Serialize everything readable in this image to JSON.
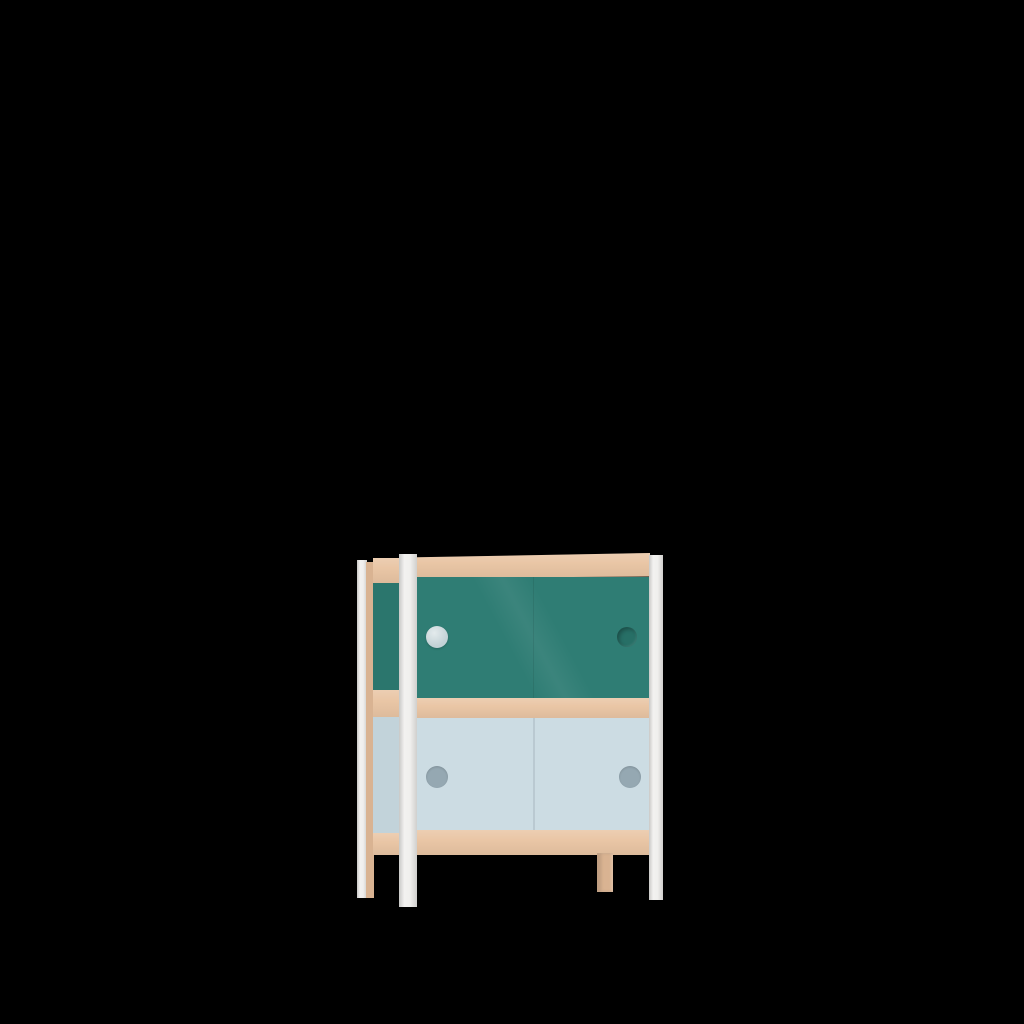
{
  "scene": {
    "kind": "3d-product-render",
    "description": "Two-tier cabinet with sliding doors: teal upper doors, pale blue lower doors, birch wood rails and white frame posts, rendered on a black background",
    "background_color": "#000000"
  },
  "cabinet": {
    "colors": {
      "wood": "#e9c5a4",
      "wood_shaded": "#d9b392",
      "upper_door_teal": "#2f7d74",
      "upper_side_teal": "#2b766d",
      "lower_door_blue": "#ccdce3",
      "lower_side_blue": "#c2d3da",
      "post_white": "#efeeec",
      "upper_left_handle": "#c3d2d6",
      "upper_right_handle": "#276f66",
      "lower_handle": "#95a8b2",
      "door_seam": "#bac9d1"
    },
    "parts": {
      "rear_left_post": "rear left post",
      "side_wood_edge": "side panel wood edge",
      "side_top_rail": "side top rail",
      "side_upper_panel": "upper side panel",
      "side_middle_rail": "side middle rail",
      "side_lower_panel": "lower side panel",
      "side_bottom_rail": "side bottom rail",
      "top_rail": "front top rail",
      "upper_doors": "upper sliding doors",
      "upper_left_handle": "upper left door finger hole",
      "upper_right_handle": "upper right door finger hole",
      "middle_rail": "front middle rail",
      "lower_doors": "lower sliding doors",
      "lower_left_handle": "lower left door finger hole",
      "lower_right_handle": "lower right door finger hole",
      "bottom_rail": "front bottom rail",
      "front_left_post": "front left post and leg",
      "front_right_post": "front right post and leg",
      "rear_right_leg": "rear right wood leg"
    }
  }
}
